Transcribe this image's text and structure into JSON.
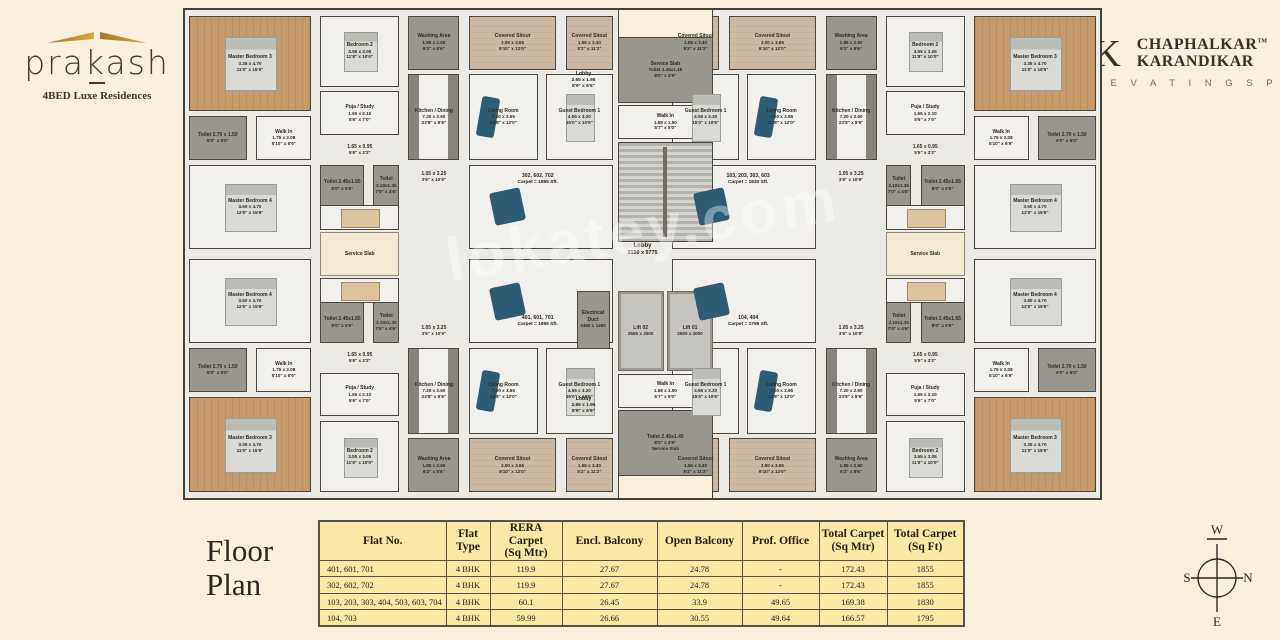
{
  "brand": {
    "name": "prakash",
    "tagline": "4BED Luxe Residences",
    "accent_color": "#b98a2f"
  },
  "developer": {
    "monogram": "CK",
    "name_line1": "CHAPHALKAR",
    "trademark": "TM",
    "name_line2": "KARANDIKAR",
    "tagline": "E L E V A T I N G   S P A C E S"
  },
  "footer": {
    "title_line1": "Floor",
    "title_line2": "Plan"
  },
  "compass": {
    "n": "N",
    "s": "S",
    "e": "E",
    "w": "W"
  },
  "plan": {
    "watermark": "lokatey.com",
    "colors": {
      "wood": "#c69c6e",
      "wet_area": "#98968f",
      "sitout": "#cbb9a3",
      "slab": "#f5ebd4",
      "sofa": "#2e5c74",
      "wall": "#44413a"
    },
    "rooms": [
      {
        "id": "master-bedroom-3",
        "type": "wood bedded",
        "lines": [
          "Master Bedroom 3",
          "3.35 x 4.70",
          "11'0\" x 15'5\""
        ],
        "rect": [
          0.4,
          1.2,
          13.4,
          19.5
        ]
      },
      {
        "id": "bedroom-2",
        "type": "tile bedded",
        "lines": [
          "Bedroom 2",
          "3.55 x 3.05",
          "11'8\" x 10'0\""
        ],
        "rect": [
          14.8,
          1.2,
          8.6,
          14.5
        ]
      },
      {
        "id": "washing-area",
        "type": "gray",
        "lines": [
          "Washing Area",
          "1.85 x 2.60",
          "6'2\" x 8'6\""
        ],
        "rect": [
          24.4,
          1.2,
          5.6,
          11
        ]
      },
      {
        "id": "covered-sitout-large",
        "type": "sitout",
        "lines": [
          "Covered Sitout",
          "3.00 x 3.65",
          "9'10\" x 12'0\""
        ],
        "rect": [
          31,
          1.2,
          9.6,
          11
        ]
      },
      {
        "id": "covered-sitout-small",
        "type": "sitout",
        "lines": [
          "Covered Sitout",
          "1.55 x 3.40",
          "5'2\" x 11'2\""
        ],
        "rect": [
          41.6,
          1.2,
          5.2,
          11
        ]
      },
      {
        "id": "toilet-master-3",
        "type": "gray",
        "lines": [
          "Toilet 2.70 x 1.50",
          "9'0\" x 5'0\""
        ],
        "rect": [
          0.4,
          21.7,
          6.4,
          9
        ]
      },
      {
        "id": "walk-in-master-3",
        "type": "tile",
        "lines": [
          "Walk In",
          "1.75 x 2.08",
          "5'10\" x 6'9\""
        ],
        "rect": [
          7.8,
          21.7,
          6,
          9
        ]
      },
      {
        "id": "puja-study",
        "type": "tile",
        "lines": [
          "Puja / Study",
          "1.65 x 2.10",
          "5'6\" x 7'0\""
        ],
        "rect": [
          14.8,
          16.7,
          8.6,
          9
        ]
      },
      {
        "id": "passage-a",
        "type": "open",
        "lines": [
          "1.65 x 0.95",
          "5'6\" x 3'2\""
        ],
        "rect": [
          14.8,
          26.7,
          8.6,
          4
        ]
      },
      {
        "id": "kitchen-dining",
        "type": "kitchen",
        "lines": [
          "Kitchen / Dining",
          "7.20 x 2.60",
          "23'8\" x 8'6\""
        ],
        "rect": [
          24.4,
          13.2,
          5.6,
          17.5
        ]
      },
      {
        "id": "living-room",
        "type": "living",
        "lines": [
          "Living Room",
          "7.00 x 3.65",
          "22'8\" x 12'0\""
        ],
        "rect": [
          31,
          13.2,
          7.6,
          17.5
        ]
      },
      {
        "id": "guest-bedroom-1",
        "type": "tile bedded",
        "lines": [
          "Guest Bedroom 1",
          "4.55 x 3.20",
          "15'0\" x 10'6\""
        ],
        "rect": [
          39.4,
          13.2,
          7.4,
          17.5
        ]
      },
      {
        "id": "master-bedroom-4",
        "type": "tile bedded",
        "lines": [
          "Master Bedroom 4",
          "3.60 x 4.70",
          "12'0\" x 15'6\""
        ],
        "rect": [
          0.4,
          31.7,
          13.4,
          17.3
        ]
      },
      {
        "id": "toilet-master-4",
        "type": "gray",
        "lines": [
          "Toilet 2.45x1.65",
          "8'0\" x 5'6\""
        ],
        "rect": [
          14.8,
          31.7,
          4.8,
          8.5
        ]
      },
      {
        "id": "toilet-common",
        "type": "gray",
        "lines": [
          "Toilet",
          "2.10x1.35",
          "7'0\" x 4'6\""
        ],
        "rect": [
          20.6,
          31.7,
          2.8,
          8.5
        ]
      },
      {
        "id": "passage-b",
        "type": "open",
        "lines": [
          "1.05 x 3.25",
          "3'6\" x 10'9\""
        ],
        "rect": [
          24.4,
          31.7,
          5.6,
          5
        ]
      },
      {
        "id": "dining-area",
        "type": "tile dining",
        "lines": [],
        "rect": [
          14.8,
          40,
          8.6,
          5
        ]
      },
      {
        "id": "family-lounge",
        "type": "tile sofaarea",
        "lines": [],
        "rect": [
          31,
          31.7,
          15.8,
          17.3
        ]
      }
    ],
    "core": [
      {
        "id": "notch-top",
        "type": "notch",
        "lines": [],
        "rect": [
          47.3,
          0,
          10.4,
          5.5
        ]
      },
      {
        "id": "service-toilet-top",
        "type": "gray",
        "lines": [
          "Service Slab",
          "Toilet 2.45x1.45",
          "8'0\" x 4'9\""
        ],
        "rect": [
          47.3,
          5.5,
          10.4,
          13.5
        ]
      },
      {
        "id": "walk-in-top",
        "type": "tile",
        "lines": [
          "Walk In",
          "1.68 x 1.50",
          "5'7\" x 5'0\""
        ],
        "rect": [
          47.3,
          19.5,
          10.4,
          7
        ]
      },
      {
        "id": "staircase",
        "type": "stair",
        "lines": [],
        "rect": [
          47.3,
          27,
          10.4,
          20.5
        ]
      },
      {
        "id": "electrical-duct",
        "type": "gray",
        "lines": [
          "Electrical Duct",
          "2450 x 1450"
        ],
        "rect": [
          42.8,
          57.5,
          3.6,
          12
        ]
      },
      {
        "id": "lift-02",
        "type": "lift",
        "lines": [
          "Lift 02",
          "2500 x 2000"
        ],
        "rect": [
          47.3,
          57.5,
          5,
          16.5
        ]
      },
      {
        "id": "lift-01",
        "type": "lift",
        "lines": [
          "Lift 01",
          "2500 x 2000"
        ],
        "rect": [
          52.7,
          57.5,
          5,
          16.5
        ]
      },
      {
        "id": "walk-in-bottom",
        "type": "tile",
        "lines": [
          "Walk In",
          "1.68 x 1.50",
          "5'7\" x 5'0\""
        ],
        "rect": [
          47.3,
          74.5,
          10.4,
          7
        ]
      },
      {
        "id": "service-toilet-bottom",
        "type": "gray",
        "lines": [
          "Toilet 2.45x1.45",
          "8'0\" x 4'9\"",
          "Service Slab"
        ],
        "rect": [
          47.3,
          82,
          10.4,
          13.5
        ]
      },
      {
        "id": "notch-bottom",
        "type": "notch",
        "lines": [],
        "rect": [
          47.3,
          95.5,
          10.4,
          4.5
        ]
      },
      {
        "id": "service-slab-left",
        "type": "slab",
        "lines": [
          "Service Slab"
        ],
        "rect": [
          14.8,
          45.4,
          8.6,
          9.2
        ]
      },
      {
        "id": "service-slab-right",
        "type": "slab",
        "lines": [
          "Service Slab"
        ],
        "rect": [
          76.6,
          45.4,
          8.6,
          9.2
        ]
      }
    ],
    "labels": [
      {
        "id": "flat-302",
        "big": false,
        "lines": [
          "302, 602, 702",
          "Carpet = 1855 Sft."
        ],
        "pos": [
          33.8,
          33.5,
          9.5
        ]
      },
      {
        "id": "flat-103",
        "big": false,
        "lines": [
          "103, 203, 303, 603",
          "Carpet = 1830 Sft."
        ],
        "pos": [
          56.8,
          33.5,
          9.5
        ]
      },
      {
        "id": "flat-401",
        "big": false,
        "lines": [
          "401, 601, 701",
          "Carpet = 1855 Sft."
        ],
        "pos": [
          33.8,
          62.5,
          9.5
        ]
      },
      {
        "id": "flat-104",
        "big": false,
        "lines": [
          "104, 404",
          "Carpet = 1795 Sft."
        ],
        "pos": [
          56.8,
          62.5,
          9.5
        ]
      },
      {
        "id": "lobby-upper",
        "big": false,
        "lines": [
          "Lobby",
          "2.65 x 1.95",
          "8'9\" x 6'6\""
        ],
        "pos": [
          40.3,
          12.5,
          6.5
        ]
      },
      {
        "id": "lobby-lower",
        "big": false,
        "lines": [
          "Lobby",
          "2.65 x 1.95",
          "8'9\" x 6'6\""
        ],
        "pos": [
          40.3,
          79,
          6.5
        ]
      },
      {
        "id": "lobby-main",
        "big": true,
        "lines": [
          "Lobby",
          "2150 x 9775"
        ],
        "pos": [
          44,
          47.5,
          12
        ]
      }
    ]
  },
  "table": {
    "col_widths": [
      127,
      44,
      72,
      95,
      85,
      77,
      68,
      77
    ],
    "headers": [
      "Flat No.",
      "Flat Type",
      "RERA Carpet|(Sq Mtr)",
      "Encl. Balcony",
      "Open Balcony",
      "Prof. Office",
      "Total Carpet|(Sq Mtr)",
      "Total Carpet|(Sq Ft)"
    ],
    "rows": [
      [
        "401, 601, 701",
        "4 BHK",
        "119.9",
        "27.67",
        "24.78",
        "-",
        "172.43",
        "1855"
      ],
      [
        "302, 602, 702",
        "4 BHK",
        "119.9",
        "27.67",
        "24.78",
        "-",
        "172.43",
        "1855"
      ],
      [
        "103, 203, 303, 404, 503, 603, 704",
        "4 BHK",
        "60.1",
        "26.45",
        "33.9",
        "49.65",
        "169.38",
        "1830"
      ],
      [
        "104, 703",
        "4 BHK",
        "59.99",
        "26.66",
        "30.55",
        "49.64",
        "166.57",
        "1795"
      ]
    ]
  }
}
